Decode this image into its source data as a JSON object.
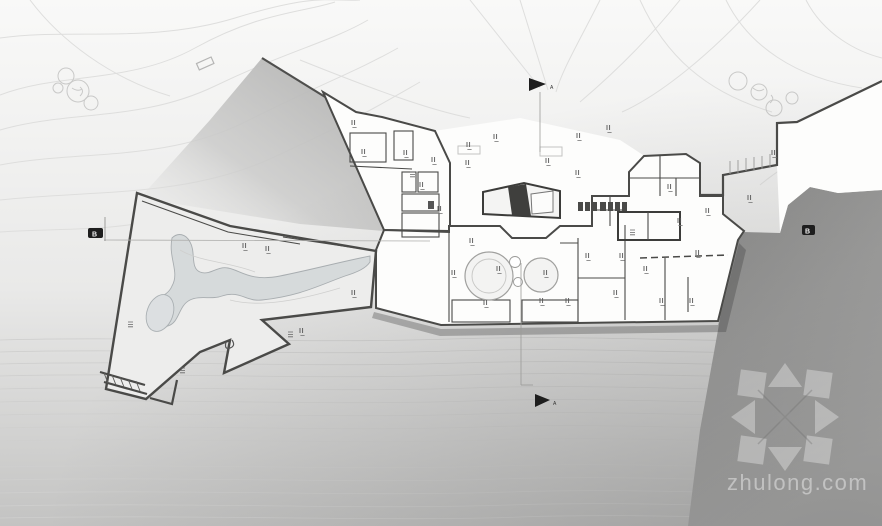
{
  "document": {
    "type": "Architectural ground floor / site plan drawing",
    "legible_text_note": "Room and dimension labels in the plan are below legibility; only watermark and section letters are readable"
  },
  "watermark": {
    "text": "zhulong.com",
    "logo": "compass-arrows-logo"
  },
  "section_markers": {
    "a_top": "A",
    "a_bottom": "A",
    "b_left": "B",
    "b_right": "B"
  },
  "colors": {
    "background_top": "#f9f9f8",
    "background_bottom": "#c3c3c2",
    "terrain_slope_dark": "#8e8e8d",
    "terrain_wedge": "#b5b5b4",
    "building_fill": "#fdfdfc",
    "wall_line": "#4a4a48",
    "contour_line": "#dedeDD",
    "water_fill": "#d6dadb",
    "marker_fill": "#1e1e1e",
    "watermark_color": "rgba(255,255,255,0.32)"
  }
}
